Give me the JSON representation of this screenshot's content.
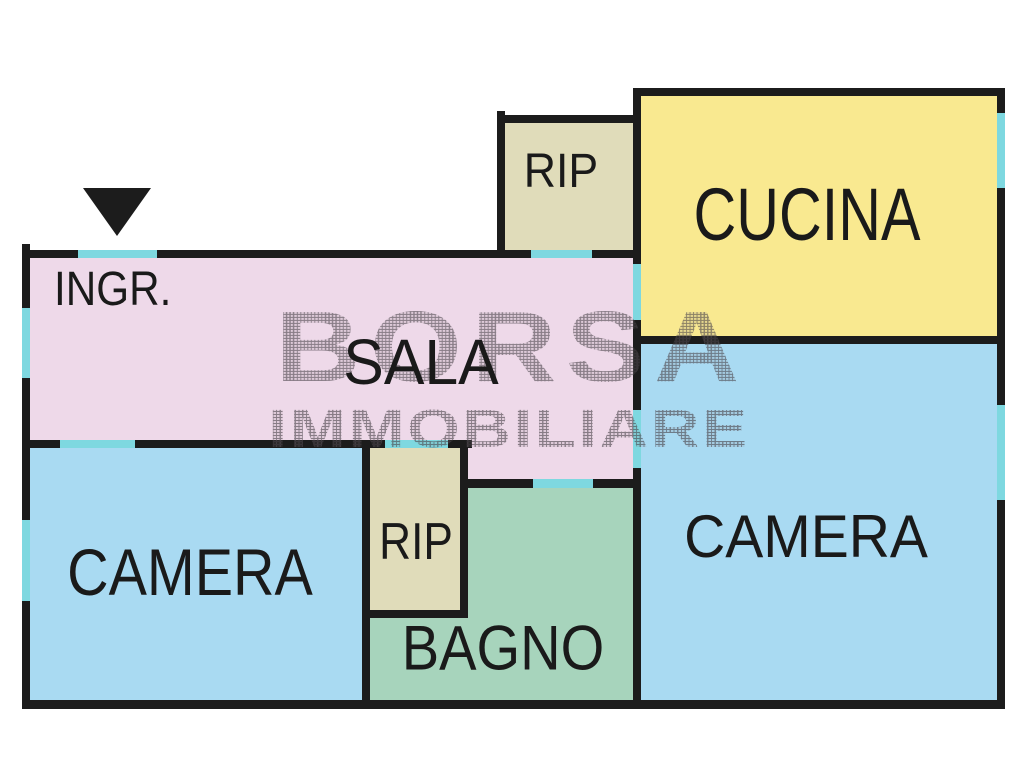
{
  "watermark": {
    "line1": "BORSA",
    "line2": "IMMOBILIARE"
  },
  "rooms": {
    "ingr": {
      "label": "INGR."
    },
    "sala": {
      "label": "SALA"
    },
    "rip_top": {
      "label": "RIP"
    },
    "cucina": {
      "label": "CUCINA"
    },
    "camera_left": {
      "label": "CAMERA"
    },
    "rip_mid": {
      "label": "RIP"
    },
    "bagno": {
      "label": "BAGNO"
    },
    "camera_right": {
      "label": "CAMERA"
    }
  },
  "colors": {
    "page_bg": "#ffffff",
    "wall": "#1c1c1c",
    "pink": "#eed9e9",
    "yellow": "#f9e990",
    "blue": "#a9daf2",
    "green": "#a7d4bc",
    "beige": "#e0dcba",
    "cyan": "#7ed8e0",
    "label": "#1a1a1a",
    "watermark": "#4a444a"
  }
}
